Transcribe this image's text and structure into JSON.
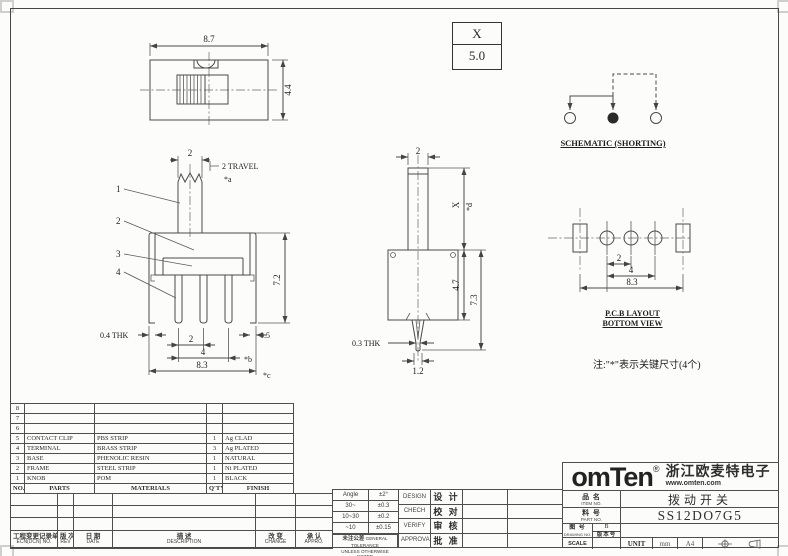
{
  "xbox": {
    "param": "X",
    "value": "5.0"
  },
  "top_view": {
    "dim_width": "8.7",
    "dim_height": "4.4"
  },
  "schematic": {
    "label": "SCHEMATIC (SHORTING)"
  },
  "front_view": {
    "dim_knob": "2",
    "travel": "2 TRAVEL",
    "star_a": "*a",
    "b1": "1",
    "b2": "2",
    "b3": "3",
    "b4": "4",
    "dim_height": "7.2",
    "thk": "0.4 THK",
    "dim_right": "0.5",
    "dim_pitch": "2",
    "dim_span": "4",
    "star_b": "*b",
    "dim_total": "8.3",
    "star_c": "*c"
  },
  "side_view": {
    "dim_top": "2",
    "dim_x": "X",
    "star_d": "*d",
    "dim_body": "4.7",
    "dim_total": "7.3",
    "thk": "0.3 THK",
    "dim_tip": "1.2"
  },
  "pcb": {
    "dim_pitch": "2",
    "dim_span": "4",
    "dim_total": "8.3",
    "title1": "P.C.B LAYOUT",
    "title2": "BOTTOM VIEW"
  },
  "note": "注:\"*\"表示关键尺寸(4个)",
  "parts_table": {
    "headers": {
      "no": "NO.",
      "parts": "PARTS",
      "materials": "MATERIALS",
      "qty": "Q'TY",
      "finish": "FINISH"
    },
    "rows": [
      {
        "no": "8",
        "parts": "",
        "materials": "",
        "qty": "",
        "finish": ""
      },
      {
        "no": "7",
        "parts": "",
        "materials": "",
        "qty": "",
        "finish": ""
      },
      {
        "no": "6",
        "parts": "",
        "materials": "",
        "qty": "",
        "finish": ""
      },
      {
        "no": "5",
        "parts": "CONTACT CLIP",
        "materials": "PBS STRIP",
        "qty": "1",
        "finish": "Ag CLAD"
      },
      {
        "no": "4",
        "parts": "TERMINAL",
        "materials": "BRASS STRIP",
        "qty": "3",
        "finish": "Ag PLATED"
      },
      {
        "no": "3",
        "parts": "BASE",
        "materials": "PHENOLIC RESIN",
        "qty": "1",
        "finish": "NATURAL"
      },
      {
        "no": "2",
        "parts": "FRAME",
        "materials": "STEEL STRIP",
        "qty": "1",
        "finish": "Ni PLATED"
      },
      {
        "no": "1",
        "parts": "KNOB",
        "materials": "POM",
        "qty": "1",
        "finish": "BLACK"
      }
    ]
  },
  "ecn": {
    "col1_cn": "工程变更记录单",
    "col1_en": "ECN(DCN) NO.",
    "col2_cn": "版 次",
    "col2_en": "REV",
    "col3_cn": "日 期",
    "col3_en": "DATE",
    "col4_cn": "描 述",
    "col4_en": "DESCRIPTION",
    "col5_cn": "改 变",
    "col5_en": "CHANGE",
    "col6_cn": "承 认",
    "col6_en": "APPRO."
  },
  "tolerance": {
    "r1c1": "Angle",
    "r1c2": "±2°",
    "r2c1": "30~",
    "r2c2": "±0.3",
    "r3c1": "10~30",
    "r3c2": "±0.2",
    "r4c1": "~10",
    "r4c2": "±0.15",
    "note_cn": "未注公差",
    "note_en1": "GENERAL TOLERANCE",
    "note_en2": "UNLESS OTHERWISE NOTED"
  },
  "signoff": {
    "design_en": "DESIGN",
    "design_cn": "设 计",
    "check_en": "CHECH",
    "check_cn": "校 对",
    "verify_en": "VERIFY",
    "verify_cn": "审 核",
    "approval_en": "APPROVAL",
    "approval_cn": "批 准"
  },
  "title_block": {
    "logo_text": "omTen",
    "logo_reg": "®",
    "company": "浙江欧麦特电子",
    "website": "www.omten.com",
    "item_label_cn": "品 名",
    "item_label_en": "ITEM NO.",
    "item_value": "拨动开关",
    "part_label_cn": "料 号",
    "part_label_en": "PART NO.",
    "part_value": "SS12DO7G5",
    "drawing_label_cn": "图 号",
    "drawing_label_en": "DRAWING NO.",
    "drawing_rev": "B",
    "drawing_rev_label": "版本号",
    "scale_label": "SCALE",
    "unit_label": "UNIT",
    "unit_value": "mm",
    "paper_size": "A4"
  }
}
